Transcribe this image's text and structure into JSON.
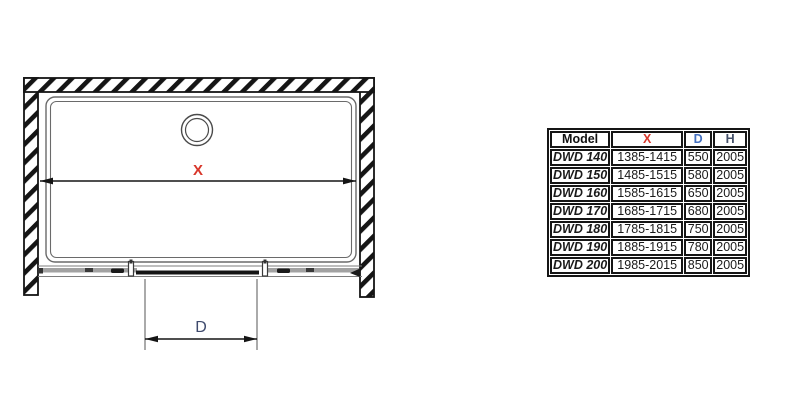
{
  "diagram": {
    "x_dim_label": "X",
    "d_dim_label": "D",
    "x_color": "#d8362a",
    "d_color": "#3e4a6d",
    "line_color": "#151515"
  },
  "table": {
    "headers": [
      {
        "label": "Model",
        "color": "#111111"
      },
      {
        "label": "X",
        "color": "#d8362a"
      },
      {
        "label": "D",
        "color": "#4470c0"
      },
      {
        "label": "H",
        "color": "#445069"
      }
    ],
    "rows": [
      {
        "model": "DWD 140",
        "x_range": "1385-1415",
        "d": "550",
        "h": "2005"
      },
      {
        "model": "DWD 150",
        "x_range": "1485-1515",
        "d": "580",
        "h": "2005"
      },
      {
        "model": "DWD 160",
        "x_range": "1585-1615",
        "d": "650",
        "h": "2005"
      },
      {
        "model": "DWD 170",
        "x_range": "1685-1715",
        "d": "680",
        "h": "2005"
      },
      {
        "model": "DWD 180",
        "x_range": "1785-1815",
        "d": "750",
        "h": "2005"
      },
      {
        "model": "DWD 190",
        "x_range": "1885-1915",
        "d": "780",
        "h": "2005"
      },
      {
        "model": "DWD 200",
        "x_range": "1985-2015",
        "d": "850",
        "h": "2005"
      }
    ]
  }
}
